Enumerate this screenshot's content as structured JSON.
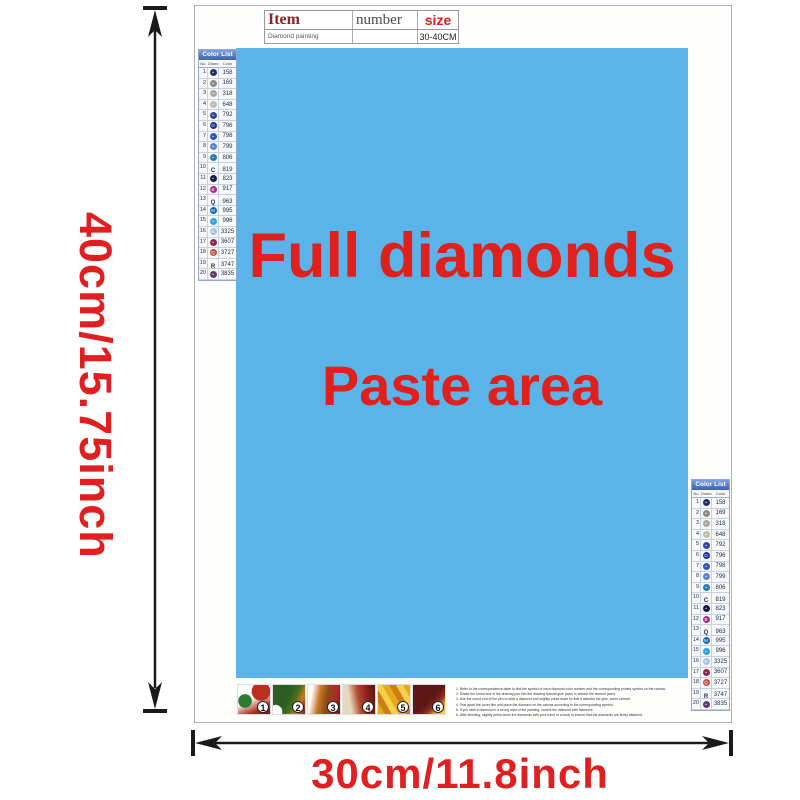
{
  "size_labels": {
    "height": "40cm/15.75inch",
    "width": "30cm/11.8inch"
  },
  "item_table": {
    "col_item": "Item",
    "col_number": "number",
    "col_size": "size",
    "row_item": "Diamond painting",
    "row_number": "",
    "row_size": "30-40CM"
  },
  "paste_area": {
    "line1": "Full diamonds",
    "line2": "Paste area"
  },
  "colors": {
    "canvas_blue": "#5bb4e9",
    "accent_red": "#e0201c"
  },
  "color_list": {
    "title": "Color List",
    "headers": [
      "No.",
      "Diamond",
      "Color"
    ],
    "rows": [
      {
        "no": "1",
        "type": "circle",
        "color": "#232c66",
        "glyph": "•",
        "code": "158"
      },
      {
        "no": "2",
        "type": "circle",
        "color": "#8b8b89",
        "glyph": "•",
        "code": "169"
      },
      {
        "no": "3",
        "type": "circle",
        "color": "#a6a6a4",
        "glyph": "•",
        "code": "318"
      },
      {
        "no": "4",
        "type": "circle",
        "color": "#bfbcae",
        "glyph": "•",
        "code": "648"
      },
      {
        "no": "5",
        "type": "circle",
        "color": "#31479e",
        "glyph": "•",
        "code": "792"
      },
      {
        "no": "6",
        "type": "circle",
        "color": "#1b2d9b",
        "glyph": "O",
        "code": "796"
      },
      {
        "no": "7",
        "type": "circle",
        "color": "#2e54bd",
        "glyph": "•",
        "code": "798"
      },
      {
        "no": "8",
        "type": "circle",
        "color": "#5b82d4",
        "glyph": "•",
        "code": "799"
      },
      {
        "no": "9",
        "type": "circle",
        "color": "#2b79ae",
        "glyph": "•",
        "code": "806"
      },
      {
        "no": "10",
        "type": "letter",
        "letter": "C",
        "code": "819"
      },
      {
        "no": "11",
        "type": "circle",
        "color": "#131b45",
        "glyph": "•",
        "code": "823"
      },
      {
        "no": "12",
        "type": "circle",
        "color": "#9e2d88",
        "glyph": "B",
        "code": "917"
      },
      {
        "no": "13",
        "type": "letter",
        "letter": "Q",
        "code": "963"
      },
      {
        "no": "14",
        "type": "circle",
        "color": "#1763b0",
        "glyph": "M",
        "code": "995"
      },
      {
        "no": "15",
        "type": "circle",
        "color": "#2f9fe4",
        "glyph": "•",
        "code": "996"
      },
      {
        "no": "16",
        "type": "circle",
        "color": "#a2c2e6",
        "glyph": "K",
        "code": "3325"
      },
      {
        "no": "17",
        "type": "circle",
        "color": "#8e2350",
        "glyph": "•",
        "code": "3607"
      },
      {
        "no": "18",
        "type": "circle",
        "color": "#c14f44",
        "glyph": "Q",
        "code": "3727"
      },
      {
        "no": "19",
        "type": "letter",
        "letter": "R",
        "code": "3747"
      },
      {
        "no": "20",
        "type": "circle",
        "color": "#5f3a70",
        "glyph": "•",
        "code": "3835"
      }
    ]
  },
  "steps": [
    "1",
    "2",
    "3",
    "4",
    "5",
    "6"
  ],
  "instructions": [
    "1. Refer to the correspondence table to find the symbol of each diamond color number and the corresponding printed symbol on the canvas.",
    "2. Shake the round end of the drawing pen into the drawing special glue (wax) to absorb the cement (wax).",
    "3. Use the round end of the pen to stick a diamond and slightly press down so that it absorbs the glue, some cement.",
    "4. Tear apart the cover film and place the diamond on the canvas according to the corresponding symbol.",
    "5. If you stick a diamond in a wrong area of the painting, correct the diamond with tweezers.",
    "6. After finishing, slightly press down the diamonds with your hand or a book to ensure that the diamonds are firmly attached."
  ]
}
